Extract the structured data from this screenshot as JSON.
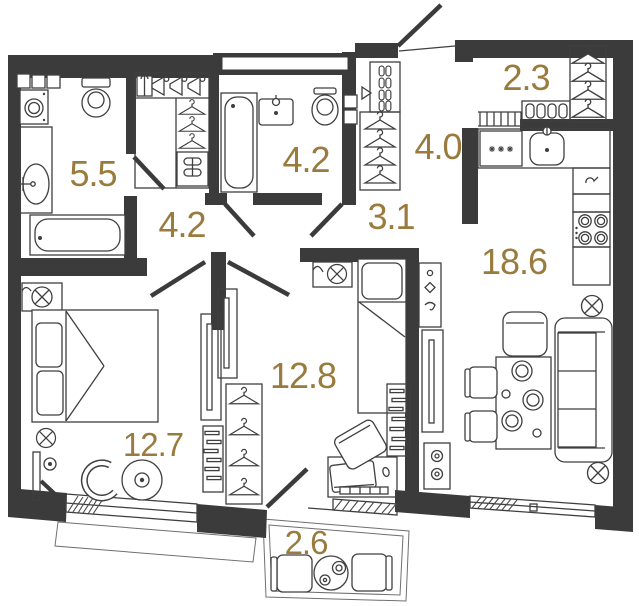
{
  "floor_plan": {
    "type": "apartment-floor-plan",
    "rooms": [
      {
        "id": "bathroom-small",
        "label": "5.5"
      },
      {
        "id": "hallway",
        "label": "4.2"
      },
      {
        "id": "bathroom-large",
        "label": "4.2"
      },
      {
        "id": "hall",
        "label": "3.1"
      },
      {
        "id": "pantry",
        "label": "2.3"
      },
      {
        "id": "corridor",
        "label": "4.0"
      },
      {
        "id": "kitchen-living-room",
        "label": "18.6"
      },
      {
        "id": "bedroom",
        "label": "12.8"
      },
      {
        "id": "bedroom-master",
        "label": "12.7"
      },
      {
        "id": "balcony",
        "label": "2.6"
      }
    ],
    "colors": {
      "wall": "#3b3b3b",
      "furniture_line": "#3f3f3f",
      "room_label": "#9a7b3e",
      "background": "#ffffff"
    },
    "fixtures": [
      "entrance-door-swing",
      "door-swing",
      "window",
      "balcony-glazing",
      "washing-machine-icon",
      "toilet-icon",
      "sink-icon",
      "bathtub-icon",
      "wardrobe-hanger-icon",
      "coat-rack-icon",
      "shoe-shelf-icon",
      "radiator-icon",
      "kitchen-sink-icon",
      "dishwasher-icon",
      "stove-icon",
      "kettle-icon",
      "ceiling-light-icon",
      "sofa-icon",
      "armchair-icon",
      "dining-table-icon",
      "chair-icon",
      "double-bed-icon",
      "single-bed-icon",
      "tv-panel-icon",
      "bookshelf-icon",
      "desk-icon",
      "laptop-icon",
      "keyboard-icon",
      "floor-lamp-icon",
      "round-table-icon",
      "balcony-chair-icon",
      "coffee-table-icon",
      "wall-hooks-icon",
      "bottle-shelf-icon"
    ]
  }
}
